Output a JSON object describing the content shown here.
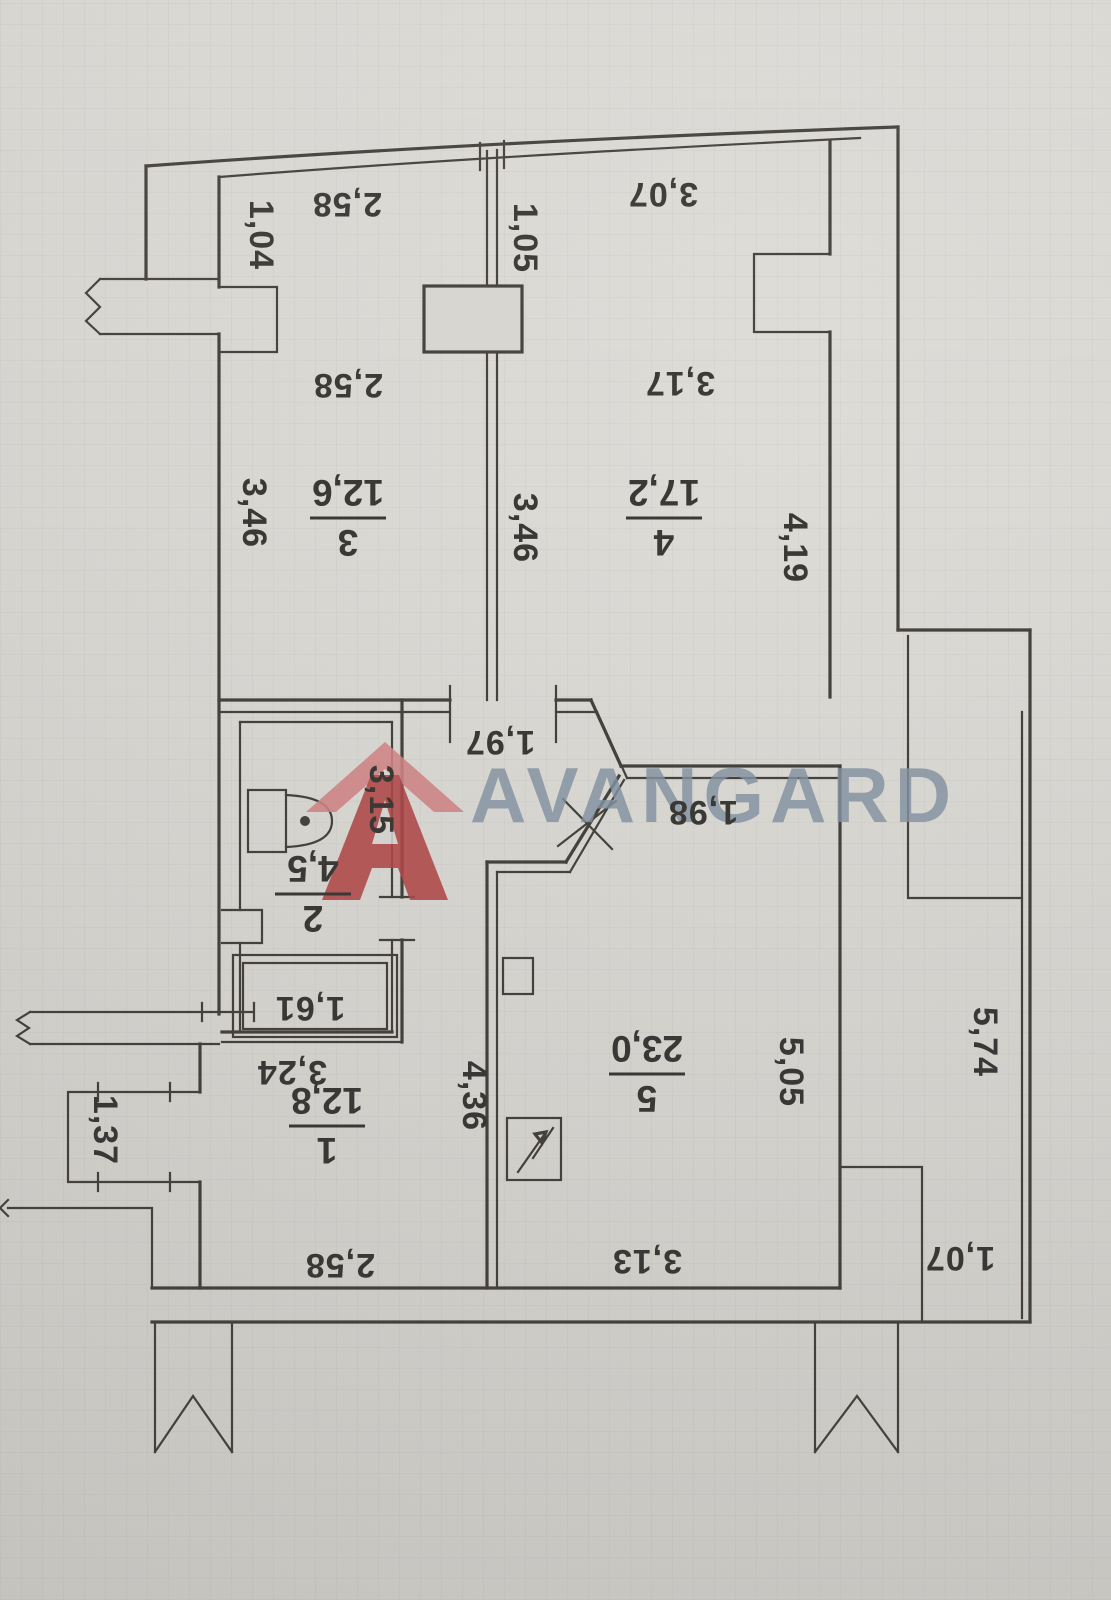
{
  "palette": {
    "paper": "#d7d5d0",
    "wall_line": "#45423d",
    "label_ink": "#3b3936",
    "watermark_text_color": "#8493a2",
    "logo_red_dark": "#b14848",
    "logo_red_light": "#d08585"
  },
  "watermark": {
    "text": "AVANGARD",
    "logo": "house-a-icon"
  },
  "rooms": [
    {
      "number": "1",
      "area": "12,8"
    },
    {
      "number": "2",
      "area": "4,5"
    },
    {
      "number": "3",
      "area": "12,6"
    },
    {
      "number": "4",
      "area": "17,2"
    },
    {
      "number": "5",
      "area": "23,0"
    }
  ],
  "plan": {
    "orientation_note": "scan rotated 180deg - all plan text appears upside down",
    "dim_labels": [
      {
        "text": "2,58",
        "x": 347,
        "y": 193,
        "r": 180
      },
      {
        "text": "1,04",
        "x": 250,
        "y": 235,
        "r": 90
      },
      {
        "text": "3,07",
        "x": 663,
        "y": 183,
        "r": 180
      },
      {
        "text": "1,05",
        "x": 514,
        "y": 238,
        "r": 90
      },
      {
        "text": "2,58",
        "x": 348,
        "y": 374,
        "r": 180
      },
      {
        "text": "3,17",
        "x": 680,
        "y": 372,
        "r": 180
      },
      {
        "text": "3,46",
        "x": 243,
        "y": 513,
        "r": 90
      },
      {
        "text": "3,46",
        "x": 514,
        "y": 528,
        "r": 90
      },
      {
        "text": "4,19",
        "x": 784,
        "y": 548,
        "r": 90
      },
      {
        "text": "1,97",
        "x": 500,
        "y": 731,
        "r": 180
      },
      {
        "text": "1,98",
        "x": 703,
        "y": 801,
        "r": 180
      },
      {
        "text": "3,15",
        "x": 370,
        "y": 800,
        "r": 90
      },
      {
        "text": "1,61",
        "x": 310,
        "y": 997,
        "r": 180
      },
      {
        "text": "3,24",
        "x": 292,
        "y": 1061,
        "r": 180
      },
      {
        "text": "4,36",
        "x": 463,
        "y": 1096,
        "r": 90
      },
      {
        "text": "5,05",
        "x": 780,
        "y": 1072,
        "r": 90
      },
      {
        "text": "5,74",
        "x": 974,
        "y": 1042,
        "r": 90
      },
      {
        "text": "1,37",
        "x": 94,
        "y": 1130,
        "r": 90
      },
      {
        "text": "2,58",
        "x": 340,
        "y": 1254,
        "r": 180
      },
      {
        "text": "3,13",
        "x": 647,
        "y": 1250,
        "r": 180
      },
      {
        "text": "1,07",
        "x": 960,
        "y": 1247,
        "r": 180
      }
    ],
    "room_labels": [
      {
        "number": "1",
        "area": "12,8",
        "x": 327,
        "y": 1128
      },
      {
        "number": "2",
        "area": "4,5",
        "x": 313,
        "y": 896
      },
      {
        "number": "3",
        "area": "12,6",
        "x": 348,
        "y": 520
      },
      {
        "number": "4",
        "area": "17,2",
        "x": 664,
        "y": 520
      },
      {
        "number": "5",
        "area": "23,0",
        "x": 647,
        "y": 1076
      }
    ]
  }
}
